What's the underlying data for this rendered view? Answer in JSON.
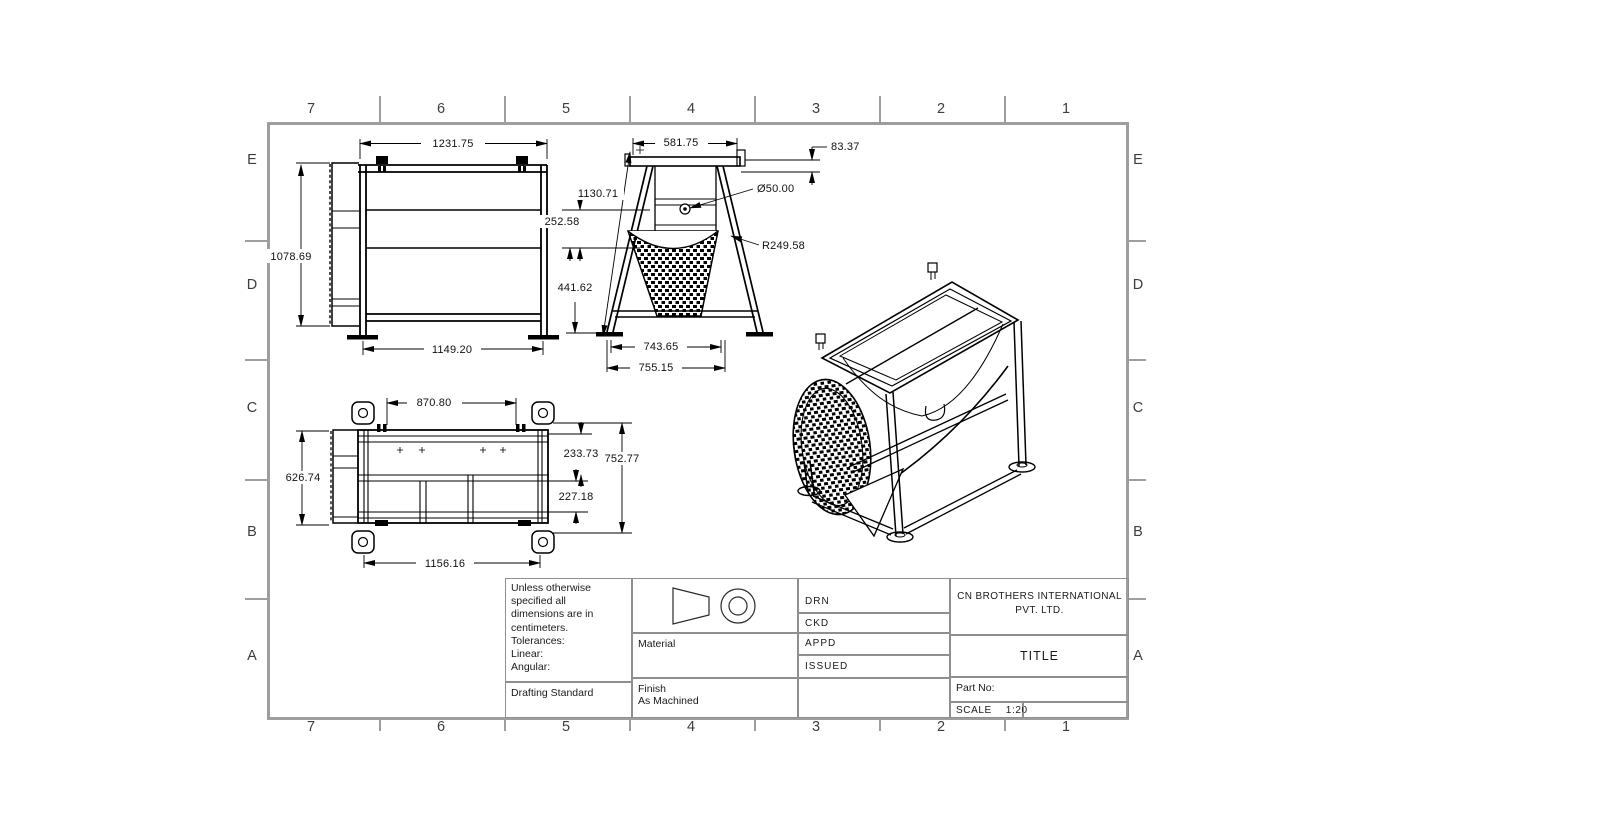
{
  "sheet": {
    "zone_columns": [
      "7",
      "6",
      "5",
      "4",
      "3",
      "2",
      "1"
    ],
    "zone_rows": [
      "E",
      "D",
      "C",
      "B",
      "A"
    ]
  },
  "views": {
    "front": {
      "dim_width_top": "1231.75",
      "dim_height": "1078.69",
      "dim_width_bottom": "1149.20"
    },
    "side": {
      "dim_width_top": "581.75",
      "dim_offset": "83.37",
      "dim_shaft_diameter": "Ø50.00",
      "dim_drum_radius": "R249.58",
      "dim_leg_slant": "1130.71",
      "dim_upper": "252.58",
      "dim_lower": "441.62",
      "dim_feet_span": "743.65",
      "dim_overall_width": "755.15"
    },
    "top": {
      "dim_clamp_span": "870.80",
      "dim_depth_left": "626.74",
      "dim_upper_right": "233.73",
      "dim_depth_right": "752.77",
      "dim_lower_right": "227.18",
      "dim_width_bottom": "1156.16"
    }
  },
  "title_block": {
    "general_notes": "Unless otherwise\nspecified all\ndimensions are in\ncentimeters.\nTolerances:\nLinear:\nAngular:",
    "drafting_standard_label": "Drafting Standard",
    "material_label": "Material",
    "finish_label": "Finish",
    "finish_value": "As Machined",
    "approval_rows": [
      "DRN",
      "CKD",
      "APPD",
      "ISSUED"
    ],
    "company_name_line1": "CN BROTHERS INTERNATIONAL",
    "company_name_line2": "PVT. LTD.",
    "title_label": "TITLE",
    "part_no_label": "Part No:",
    "scale_label": "SCALE",
    "scale_value": "1:20"
  },
  "colors": {
    "line": "#000000",
    "frame": "#9e9e9e",
    "zone_text": "#3d3d3d",
    "text": "#1a1a1a"
  }
}
